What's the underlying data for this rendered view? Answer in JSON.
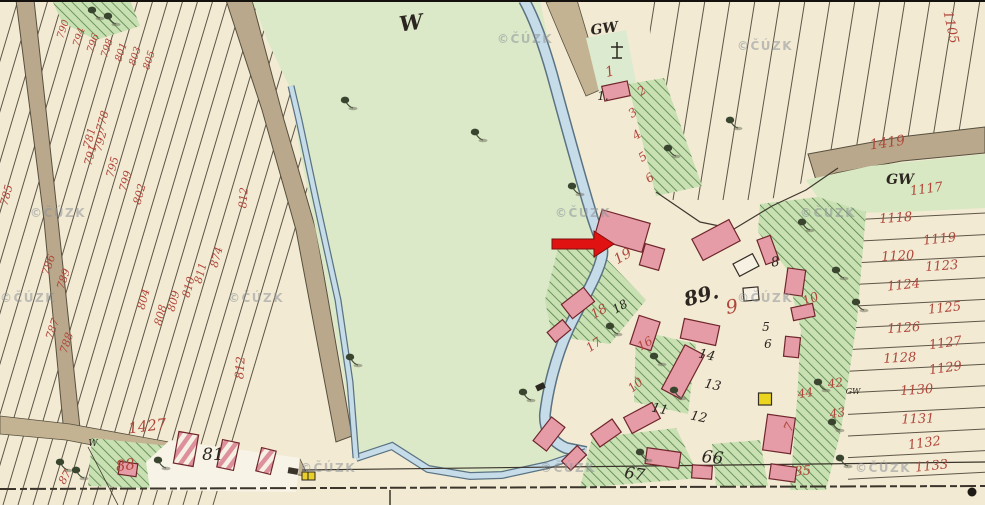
{
  "map": {
    "kind": "historical cadastral map sheet",
    "source_watermark": "©ČÚZK",
    "annotation_arrow": {
      "shape": "arrow-right",
      "color": "#e01212"
    },
    "watermark_positions": [
      [
        30,
        207
      ],
      [
        555,
        207
      ],
      [
        800,
        207
      ],
      [
        0,
        292
      ],
      [
        228,
        292
      ],
      [
        737,
        292
      ],
      [
        497,
        33
      ],
      [
        737,
        40
      ],
      [
        300,
        462
      ],
      [
        540,
        462
      ],
      [
        855,
        462
      ]
    ],
    "labels": [
      {
        "n": "label-meadow-w",
        "t": "W",
        "x": 412,
        "y": 30,
        "r": -8,
        "c": "blk",
        "s": 21,
        "b": 1
      },
      {
        "n": "label-gw-chapel",
        "t": "GW",
        "x": 605,
        "y": 33,
        "r": -8,
        "c": "blk",
        "s": 14,
        "b": 1
      },
      {
        "n": "house-1",
        "t": "1.",
        "x": 603,
        "y": 100,
        "r": 0,
        "c": "blk",
        "s": 12
      },
      {
        "n": "label-square-89",
        "t": "89.",
        "x": 703,
        "y": 302,
        "r": -15,
        "c": "blk",
        "s": 20,
        "b": 1
      },
      {
        "n": "house-81",
        "t": "81",
        "x": 213,
        "y": 460,
        "r": 0,
        "c": "blk",
        "s": 17
      },
      {
        "n": "house-66",
        "t": "66",
        "x": 712,
        "y": 463,
        "r": 6,
        "c": "blk",
        "s": 17
      },
      {
        "n": "house-67",
        "t": "67",
        "x": 634,
        "y": 479,
        "r": 8,
        "c": "blk",
        "s": 16
      },
      {
        "n": "label-gw-right",
        "t": "GW",
        "x": 900,
        "y": 184,
        "r": 0,
        "c": "blk",
        "s": 14,
        "b": 1
      },
      {
        "n": "label-gw-small",
        "t": "GW",
        "x": 853,
        "y": 394,
        "r": 0,
        "c": "blk",
        "s": 8
      },
      {
        "n": "label-w-small",
        "t": "W",
        "x": 93,
        "y": 446,
        "r": 0,
        "c": "blk",
        "s": 9
      },
      {
        "n": "house-8",
        "t": "8",
        "x": 776,
        "y": 266,
        "r": -10,
        "c": "blk",
        "s": 13
      },
      {
        "n": "house-5",
        "t": "5",
        "x": 766,
        "y": 331,
        "r": 0,
        "c": "blk",
        "s": 12
      },
      {
        "n": "house-6",
        "t": "6",
        "x": 768,
        "y": 348,
        "r": 0,
        "c": "blk",
        "s": 12
      },
      {
        "n": "house-14",
        "t": "14",
        "x": 706,
        "y": 359,
        "r": 12,
        "c": "blk",
        "s": 13
      },
      {
        "n": "house-13",
        "t": "13",
        "x": 712,
        "y": 389,
        "r": 12,
        "c": "blk",
        "s": 13
      },
      {
        "n": "house-12",
        "t": "12",
        "x": 698,
        "y": 421,
        "r": 12,
        "c": "blk",
        "s": 13
      },
      {
        "n": "house-11",
        "t": "11",
        "x": 659,
        "y": 413,
        "r": 12,
        "c": "blk",
        "s": 13
      },
      {
        "n": "house-18",
        "t": "18",
        "x": 622,
        "y": 310,
        "r": -30,
        "c": "blk",
        "s": 12
      },
      {
        "n": "parcel-1",
        "t": "1",
        "x": 611,
        "y": 76,
        "r": -15,
        "c": "red",
        "s": 14
      },
      {
        "n": "parcel-2",
        "t": "2",
        "x": 644,
        "y": 94,
        "r": -35,
        "c": "red",
        "s": 12
      },
      {
        "n": "parcel-3",
        "t": "3",
        "x": 635,
        "y": 116,
        "r": -35,
        "c": "red",
        "s": 12
      },
      {
        "n": "parcel-4",
        "t": "4",
        "x": 639,
        "y": 138,
        "r": -35,
        "c": "red",
        "s": 12
      },
      {
        "n": "parcel-5",
        "t": "5",
        "x": 645,
        "y": 160,
        "r": -35,
        "c": "red",
        "s": 12
      },
      {
        "n": "parcel-6",
        "t": "6",
        "x": 652,
        "y": 181,
        "r": -35,
        "c": "red",
        "s": 12
      },
      {
        "n": "parcel-19",
        "t": "19",
        "x": 625,
        "y": 260,
        "r": -30,
        "c": "red",
        "s": 14
      },
      {
        "n": "parcel-18",
        "t": "18",
        "x": 601,
        "y": 315,
        "r": -30,
        "c": "red",
        "s": 13
      },
      {
        "n": "parcel-17",
        "t": "17",
        "x": 596,
        "y": 348,
        "r": -35,
        "c": "red",
        "s": 12
      },
      {
        "n": "parcel-16",
        "t": "16",
        "x": 647,
        "y": 347,
        "r": -30,
        "c": "red",
        "s": 12
      },
      {
        "n": "parcel-10-a",
        "t": "10",
        "x": 638,
        "y": 388,
        "r": -40,
        "c": "red",
        "s": 12
      },
      {
        "n": "parcel-9",
        "t": "9",
        "x": 733,
        "y": 313,
        "r": -10,
        "c": "red",
        "s": 19
      },
      {
        "n": "parcel-10-b",
        "t": "10",
        "x": 812,
        "y": 303,
        "r": -22,
        "c": "red",
        "s": 13
      },
      {
        "n": "parcel-44",
        "t": "44",
        "x": 806,
        "y": 397,
        "r": -8,
        "c": "red",
        "s": 12
      },
      {
        "n": "parcel-42",
        "t": "42",
        "x": 836,
        "y": 387,
        "r": -8,
        "c": "red",
        "s": 12
      },
      {
        "n": "parcel-43",
        "t": "43",
        "x": 838,
        "y": 417,
        "r": -8,
        "c": "red",
        "s": 12
      },
      {
        "n": "parcel-35",
        "t": "35",
        "x": 803,
        "y": 475,
        "r": -4,
        "c": "red",
        "s": 13
      },
      {
        "n": "parcel-7",
        "t": "7",
        "x": 793,
        "y": 429,
        "r": -65,
        "c": "red",
        "s": 13
      },
      {
        "n": "parcel-1427",
        "t": "1427",
        "x": 148,
        "y": 431,
        "r": -7,
        "c": "red",
        "s": 15
      },
      {
        "n": "parcel-88",
        "t": "88",
        "x": 126,
        "y": 470,
        "r": -8,
        "c": "red",
        "s": 15
      },
      {
        "n": "parcel-87",
        "t": "87",
        "x": 68,
        "y": 479,
        "r": -60,
        "c": "red",
        "s": 11
      },
      {
        "n": "parcel-1419",
        "t": "1419",
        "x": 888,
        "y": 147,
        "r": -8,
        "c": "red",
        "s": 14
      },
      {
        "n": "parcel-1105",
        "t": "1105",
        "x": 947,
        "y": 28,
        "r": 78,
        "c": "red",
        "s": 13
      },
      {
        "n": "parcel-1117",
        "t": "1117",
        "x": 927,
        "y": 193,
        "r": -8,
        "c": "red",
        "s": 13
      },
      {
        "n": "parcel-1118",
        "t": "1118",
        "x": 896,
        "y": 222,
        "r": -4,
        "c": "red",
        "s": 13
      },
      {
        "n": "parcel-1119",
        "t": "1119",
        "x": 940,
        "y": 243,
        "r": -6,
        "c": "red",
        "s": 13
      },
      {
        "n": "parcel-1120",
        "t": "1120",
        "x": 898,
        "y": 260,
        "r": -3,
        "c": "red",
        "s": 13
      },
      {
        "n": "parcel-1123",
        "t": "1123",
        "x": 942,
        "y": 270,
        "r": -4,
        "c": "red",
        "s": 13
      },
      {
        "n": "parcel-1124",
        "t": "1124",
        "x": 904,
        "y": 289,
        "r": -6,
        "c": "red",
        "s": 13
      },
      {
        "n": "parcel-1125",
        "t": "1125",
        "x": 945,
        "y": 312,
        "r": -6,
        "c": "red",
        "s": 13
      },
      {
        "n": "parcel-1126",
        "t": "1126",
        "x": 904,
        "y": 332,
        "r": -4,
        "c": "red",
        "s": 13
      },
      {
        "n": "parcel-1127",
        "t": "1127",
        "x": 946,
        "y": 347,
        "r": -8,
        "c": "red",
        "s": 13
      },
      {
        "n": "parcel-1128",
        "t": "1128",
        "x": 900,
        "y": 362,
        "r": -3,
        "c": "red",
        "s": 13
      },
      {
        "n": "parcel-1129",
        "t": "1129",
        "x": 946,
        "y": 372,
        "r": -8,
        "c": "red",
        "s": 13
      },
      {
        "n": "parcel-1130",
        "t": "1130",
        "x": 917,
        "y": 394,
        "r": -4,
        "c": "red",
        "s": 13
      },
      {
        "n": "parcel-1131",
        "t": "1131",
        "x": 918,
        "y": 423,
        "r": -2,
        "c": "red",
        "s": 13
      },
      {
        "n": "parcel-1132",
        "t": "1132",
        "x": 925,
        "y": 447,
        "r": -8,
        "c": "red",
        "s": 13
      },
      {
        "n": "parcel-1133",
        "t": "1133",
        "x": 932,
        "y": 470,
        "r": -6,
        "c": "red",
        "s": 13
      },
      {
        "n": "parcel-785",
        "t": "785",
        "x": 10,
        "y": 196,
        "r": -75,
        "c": "red",
        "s": 11
      },
      {
        "n": "parcel-790",
        "t": "790",
        "x": 66,
        "y": 30,
        "r": -72,
        "c": "red",
        "s": 10
      },
      {
        "n": "parcel-794",
        "t": "794",
        "x": 82,
        "y": 38,
        "r": -72,
        "c": "red",
        "s": 10
      },
      {
        "n": "parcel-796",
        "t": "796",
        "x": 96,
        "y": 44,
        "r": -72,
        "c": "red",
        "s": 10
      },
      {
        "n": "parcel-798",
        "t": "798",
        "x": 110,
        "y": 49,
        "r": -72,
        "c": "red",
        "s": 10
      },
      {
        "n": "parcel-801",
        "t": "801",
        "x": 124,
        "y": 53,
        "r": -72,
        "c": "red",
        "s": 10
      },
      {
        "n": "parcel-803",
        "t": "803",
        "x": 138,
        "y": 57,
        "r": -72,
        "c": "red",
        "s": 10
      },
      {
        "n": "parcel-805",
        "t": "805",
        "x": 152,
        "y": 61,
        "r": -72,
        "c": "red",
        "s": 10
      },
      {
        "n": "parcel-778",
        "t": "778",
        "x": 106,
        "y": 122,
        "r": -75,
        "c": "red",
        "s": 11
      },
      {
        "n": "parcel-781",
        "t": "781",
        "x": 93,
        "y": 139,
        "r": -75,
        "c": "red",
        "s": 11
      },
      {
        "n": "parcel-792",
        "t": "792",
        "x": 104,
        "y": 142,
        "r": -75,
        "c": "red",
        "s": 11
      },
      {
        "n": "parcel-791",
        "t": "791",
        "x": 94,
        "y": 156,
        "r": -75,
        "c": "red",
        "s": 11
      },
      {
        "n": "parcel-795",
        "t": "795",
        "x": 116,
        "y": 168,
        "r": -75,
        "c": "red",
        "s": 11
      },
      {
        "n": "parcel-799",
        "t": "799",
        "x": 129,
        "y": 182,
        "r": -75,
        "c": "red",
        "s": 11
      },
      {
        "n": "parcel-802",
        "t": "802",
        "x": 143,
        "y": 195,
        "r": -75,
        "c": "red",
        "s": 11
      },
      {
        "n": "parcel-786",
        "t": "786",
        "x": 52,
        "y": 266,
        "r": -72,
        "c": "red",
        "s": 11
      },
      {
        "n": "parcel-789",
        "t": "789",
        "x": 67,
        "y": 280,
        "r": -72,
        "c": "red",
        "s": 11
      },
      {
        "n": "parcel-787",
        "t": "787",
        "x": 56,
        "y": 330,
        "r": -72,
        "c": "red",
        "s": 11
      },
      {
        "n": "parcel-788",
        "t": "788",
        "x": 70,
        "y": 344,
        "r": -72,
        "c": "red",
        "s": 11
      },
      {
        "n": "parcel-804",
        "t": "804",
        "x": 147,
        "y": 300,
        "r": -75,
        "c": "red",
        "s": 11
      },
      {
        "n": "parcel-808",
        "t": "808",
        "x": 164,
        "y": 316,
        "r": -75,
        "c": "red",
        "s": 11
      },
      {
        "n": "parcel-809",
        "t": "809",
        "x": 177,
        "y": 302,
        "r": -75,
        "c": "red",
        "s": 11
      },
      {
        "n": "parcel-810",
        "t": "810",
        "x": 192,
        "y": 288,
        "r": -75,
        "c": "red",
        "s": 11
      },
      {
        "n": "parcel-811",
        "t": "811",
        "x": 204,
        "y": 274,
        "r": -75,
        "c": "red",
        "s": 11
      },
      {
        "n": "parcel-874",
        "t": "874",
        "x": 220,
        "y": 258,
        "r": -75,
        "c": "red",
        "s": 11
      },
      {
        "n": "parcel-812-a",
        "t": "812",
        "x": 247,
        "y": 198,
        "r": -86,
        "c": "red",
        "s": 11
      },
      {
        "n": "parcel-812-b",
        "t": "812",
        "x": 244,
        "y": 368,
        "r": -86,
        "c": "red",
        "s": 12
      }
    ]
  }
}
